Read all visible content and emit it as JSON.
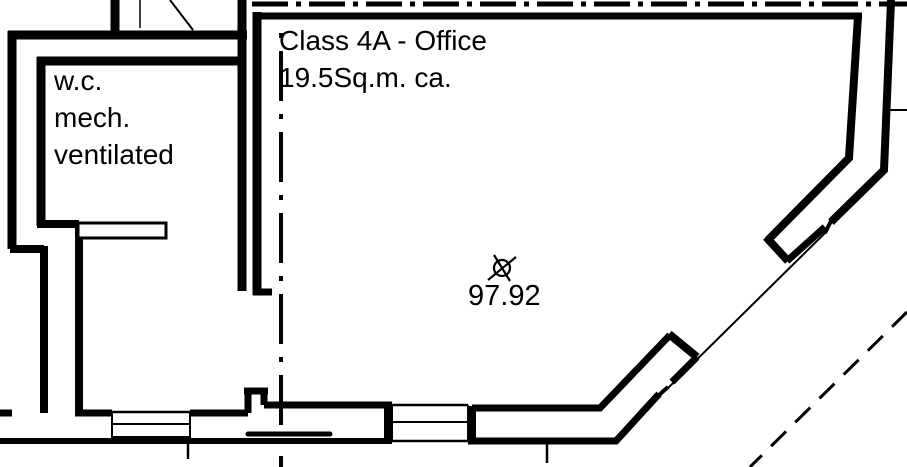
{
  "plan": {
    "office": {
      "label": "Class 4A - Office",
      "area": "19.5Sq.m. ca."
    },
    "wc": {
      "label": "w.c.\nmech.\nventilated"
    },
    "benchmark": {
      "icon": "survey-benchmark-icon",
      "value": "97.92"
    },
    "colors": {
      "line": "#000000",
      "background": "#ffffff"
    }
  }
}
